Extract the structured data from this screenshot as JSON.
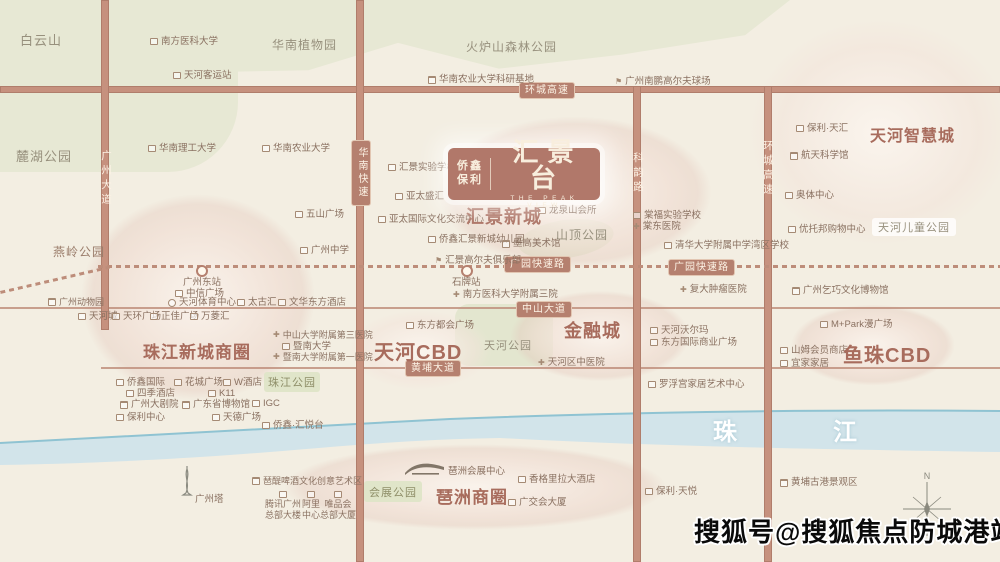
{
  "map": {
    "logo": {
      "brand_top": "侨鑫",
      "brand_bottom": "保利",
      "title": "汇景台",
      "subtitle": "THE PEAK VIEW"
    },
    "river_label": {
      "first": "珠",
      "second": "江"
    },
    "watermark": "搜狐号@搜狐焦点防城港站",
    "compass_n": "N",
    "colors": {
      "road": "#c6917e",
      "blob": "#e8d2c8",
      "park": "#e7e8d4",
      "river": "#d2e4ea",
      "badge": "#b5806f",
      "district_text": "#a86c5d",
      "watermark_text": "#0a0a0a"
    },
    "districts": [
      {
        "x": 466,
        "y": 203,
        "t": "汇景新城",
        "fs": 18
      },
      {
        "x": 870,
        "y": 122,
        "t": "天河智慧城",
        "fs": 16
      },
      {
        "x": 143,
        "y": 338,
        "t": "珠江新城商圈",
        "fs": 17
      },
      {
        "x": 374,
        "y": 336,
        "t": "天河CBD",
        "fs": 20
      },
      {
        "x": 564,
        "y": 317,
        "t": "金融城",
        "fs": 18
      },
      {
        "x": 843,
        "y": 339,
        "t": "鱼珠CBD",
        "fs": 20
      },
      {
        "x": 436,
        "y": 483,
        "t": "琶洲商圈",
        "fs": 17
      }
    ],
    "park_labels": [
      {
        "x": 20,
        "y": 30,
        "t": "白云山",
        "fs": 13,
        "cls": ""
      },
      {
        "x": 16,
        "y": 146,
        "t": "麓湖公园",
        "fs": 13,
        "cls": ""
      },
      {
        "x": 272,
        "y": 36,
        "t": "华南植物园",
        "fs": 12,
        "cls": ""
      },
      {
        "x": 466,
        "y": 38,
        "t": "火炉山森林公园",
        "fs": 12,
        "cls": ""
      },
      {
        "x": 53,
        "y": 243,
        "t": "燕岭公园",
        "fs": 12,
        "cls": "brown"
      },
      {
        "x": 556,
        "y": 226,
        "t": "山顶公园",
        "fs": 12,
        "cls": ""
      },
      {
        "x": 484,
        "y": 337,
        "t": "天河公园",
        "fs": 11,
        "cls": ""
      },
      {
        "x": 872,
        "y": 218,
        "t": "天河儿童公园",
        "fs": 11,
        "cls": "pill"
      }
    ],
    "green_boxes": [
      {
        "x": 264,
        "y": 372,
        "w": 56,
        "h": 20,
        "t": "珠江公园"
      },
      {
        "x": 364,
        "y": 481,
        "w": 58,
        "h": 21,
        "t": "会展公园"
      }
    ],
    "road_badges": [
      {
        "x": 519,
        "y": 82,
        "t": "环城高速",
        "v": false
      },
      {
        "x": 351,
        "y": 140,
        "t": "华南快速",
        "v": true
      },
      {
        "x": 504,
        "y": 256,
        "t": "广园快速路",
        "v": false
      },
      {
        "x": 668,
        "y": 259,
        "t": "广园快速路",
        "v": false
      },
      {
        "x": 516,
        "y": 301,
        "t": "中山大道",
        "v": false
      },
      {
        "x": 405,
        "y": 360,
        "t": "黄埔大道",
        "v": false
      }
    ],
    "road_names_on_road": [
      {
        "x": 99,
        "y": 150,
        "t": "广州大道"
      },
      {
        "x": 631,
        "y": 152,
        "t": "科韵路"
      },
      {
        "x": 761,
        "y": 140,
        "t": "环城高速"
      }
    ],
    "stations": [
      {
        "cx": 200,
        "cy": 269,
        "lx": 183,
        "ly": 277,
        "t": "广州东站"
      },
      {
        "cx": 465,
        "cy": 269,
        "lx": 452,
        "ly": 277,
        "t": "石牌站"
      }
    ],
    "pois": [
      {
        "x": 150,
        "y": 36,
        "ic": "b",
        "t": "南方医科大学"
      },
      {
        "x": 173,
        "y": 70,
        "ic": "b",
        "t": "天河客运站"
      },
      {
        "x": 148,
        "y": 143,
        "ic": "b",
        "t": "华南理工大学"
      },
      {
        "x": 262,
        "y": 143,
        "ic": "b",
        "t": "华南农业大学"
      },
      {
        "x": 428,
        "y": 74,
        "ic": "m",
        "t": "华南农业大学科研基地"
      },
      {
        "x": 615,
        "y": 76,
        "ic": "g",
        "t": "广州南鹏高尔夫球场"
      },
      {
        "x": 796,
        "y": 123,
        "ic": "b",
        "t": "保利·天汇"
      },
      {
        "x": 790,
        "y": 150,
        "ic": "m",
        "t": "航天科学馆"
      },
      {
        "x": 785,
        "y": 190,
        "ic": "b",
        "t": "奥体中心"
      },
      {
        "x": 788,
        "y": 224,
        "ic": "b",
        "t": "优托邦购物中心"
      },
      {
        "x": 388,
        "y": 162,
        "ic": "b",
        "t": "汇景实验学校"
      },
      {
        "x": 395,
        "y": 191,
        "ic": "b",
        "t": "亚太盛汇"
      },
      {
        "x": 378,
        "y": 214,
        "ic": "b",
        "t": "亚太国际文化交流中心"
      },
      {
        "x": 428,
        "y": 234,
        "ic": "b",
        "t": "侨鑫汇景新城幼儿园"
      },
      {
        "x": 435,
        "y": 255,
        "ic": "g",
        "t": "汇景高尔夫俱乐部"
      },
      {
        "x": 538,
        "y": 205,
        "ic": "b",
        "t": "龙泉山会所"
      },
      {
        "x": 502,
        "y": 238,
        "ic": "m",
        "t": "墨高美术馆"
      },
      {
        "x": 295,
        "y": 209,
        "ic": "b",
        "t": "五山广场"
      },
      {
        "x": 300,
        "y": 245,
        "ic": "b",
        "t": "广州中学"
      },
      {
        "x": 48,
        "y": 297,
        "ic": "m",
        "t": "广州动物园",
        "fs": 9
      },
      {
        "x": 175,
        "y": 288,
        "ic": "b",
        "t": "中信广场"
      },
      {
        "x": 168,
        "y": 297,
        "ic": "s",
        "t": "天河体育中心"
      },
      {
        "x": 237,
        "y": 297,
        "ic": "b",
        "t": "太古汇"
      },
      {
        "x": 278,
        "y": 297,
        "ic": "b",
        "t": "文华东方酒店"
      },
      {
        "x": 78,
        "y": 311,
        "ic": "b",
        "t": "天河城"
      },
      {
        "x": 112,
        "y": 311,
        "ic": "b",
        "t": "天环广场"
      },
      {
        "x": 150,
        "y": 311,
        "ic": "b",
        "t": "正佳广场"
      },
      {
        "x": 190,
        "y": 311,
        "ic": "b",
        "t": "万菱汇"
      },
      {
        "x": 453,
        "y": 289,
        "ic": "h",
        "t": "南方医科大学附属三院"
      },
      {
        "x": 273,
        "y": 330,
        "ic": "h",
        "t": "中山大学附属第三医院",
        "fs": 9
      },
      {
        "x": 282,
        "y": 341,
        "ic": "b",
        "t": "暨南大学"
      },
      {
        "x": 273,
        "y": 352,
        "ic": "h",
        "t": "暨南大学附属第一医院",
        "fs": 9
      },
      {
        "x": 116,
        "y": 377,
        "ic": "b",
        "t": "侨鑫国际"
      },
      {
        "x": 174,
        "y": 377,
        "ic": "b",
        "t": "花城广场"
      },
      {
        "x": 223,
        "y": 377,
        "ic": "b",
        "t": "W酒店"
      },
      {
        "x": 126,
        "y": 388,
        "ic": "b",
        "t": "四季酒店"
      },
      {
        "x": 208,
        "y": 388,
        "ic": "b",
        "t": "K11"
      },
      {
        "x": 120,
        "y": 399,
        "ic": "m",
        "t": "广州大剧院"
      },
      {
        "x": 182,
        "y": 399,
        "ic": "m",
        "t": "广东省博物馆"
      },
      {
        "x": 252,
        "y": 398,
        "ic": "b",
        "t": "IGC"
      },
      {
        "x": 116,
        "y": 412,
        "ic": "b",
        "t": "保利中心"
      },
      {
        "x": 212,
        "y": 412,
        "ic": "b",
        "t": "天德广场"
      },
      {
        "x": 262,
        "y": 420,
        "ic": "b",
        "t": "侨鑫·汇悦台"
      },
      {
        "x": 406,
        "y": 320,
        "ic": "b",
        "t": "东方都会广场"
      },
      {
        "x": 538,
        "y": 357,
        "ic": "h",
        "t": "天河区中医院"
      },
      {
        "x": 650,
        "y": 325,
        "ic": "b",
        "t": "天河沃尔玛"
      },
      {
        "x": 650,
        "y": 337,
        "ic": "b",
        "t": "东方国际商业广场"
      },
      {
        "x": 680,
        "y": 284,
        "ic": "h",
        "t": "复大肿瘤医院"
      },
      {
        "x": 664,
        "y": 240,
        "ic": "b",
        "t": "清华大学附属中学湾区学校"
      },
      {
        "x": 633,
        "y": 210,
        "ic": "b",
        "t": "棠福实验学校"
      },
      {
        "x": 633,
        "y": 221,
        "ic": "h",
        "t": "棠东医院"
      },
      {
        "x": 792,
        "y": 285,
        "ic": "m",
        "t": "广州乞巧文化博物馆"
      },
      {
        "x": 820,
        "y": 319,
        "ic": "b",
        "t": "M+Park漫广场"
      },
      {
        "x": 780,
        "y": 345,
        "ic": "b",
        "t": "山姆会员商店"
      },
      {
        "x": 780,
        "y": 358,
        "ic": "b",
        "t": "宜家家居"
      },
      {
        "x": 648,
        "y": 379,
        "ic": "b",
        "t": "罗浮宫家居艺术中心"
      },
      {
        "x": 252,
        "y": 476,
        "ic": "m",
        "t": "琶醍啤酒文化创意艺术区",
        "fs": 9
      },
      {
        "x": 448,
        "y": 466,
        "ic": "n",
        "t": "琶洲会展中心"
      },
      {
        "x": 518,
        "y": 474,
        "ic": "b",
        "t": "香格里拉大酒店"
      },
      {
        "x": 508,
        "y": 497,
        "ic": "b",
        "t": "广交会大厦"
      },
      {
        "x": 645,
        "y": 486,
        "ic": "b",
        "t": "保利·天悦"
      },
      {
        "x": 780,
        "y": 477,
        "ic": "m",
        "t": "黄埔古港景观区"
      },
      {
        "x": 195,
        "y": 494,
        "ic": "n",
        "t": "广州塔"
      }
    ],
    "stacked_pois": [
      {
        "cx": 283,
        "y": 491,
        "t": "腾讯广州\n总部大楼"
      },
      {
        "cx": 311,
        "y": 491,
        "t": "阿里\n中心"
      },
      {
        "cx": 338,
        "y": 491,
        "t": "唯品会\n总部大厦"
      }
    ]
  }
}
